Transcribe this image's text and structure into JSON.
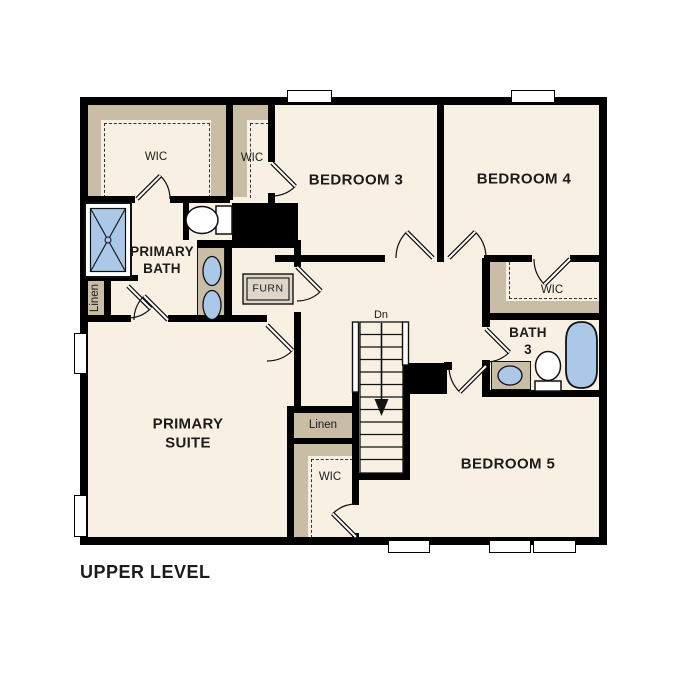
{
  "plan": {
    "title": "UPPER LEVEL",
    "labels": {
      "wic_primary": "WIC",
      "wic_bed3": "WIC",
      "wic_bed4": "WIC",
      "wic_hall": "WIC",
      "bedroom3": "BEDROOM 3",
      "bedroom4": "BEDROOM 4",
      "bedroom5": "BEDROOM 5",
      "primary_bath": "PRIMARY BATH",
      "primary_suite": "PRIMARY SUITE",
      "bath3": "BATH 3",
      "furnace": "FURN",
      "linen_bath": "Linen",
      "linen_hall": "Linen",
      "stairs_direction": "Dn"
    },
    "colors": {
      "floor": "#f8f1e3",
      "closet_shelf": "#c9bda5",
      "wall": "#000000",
      "fixture_blue": "#abc8e9",
      "paper": "#ffffff"
    }
  }
}
